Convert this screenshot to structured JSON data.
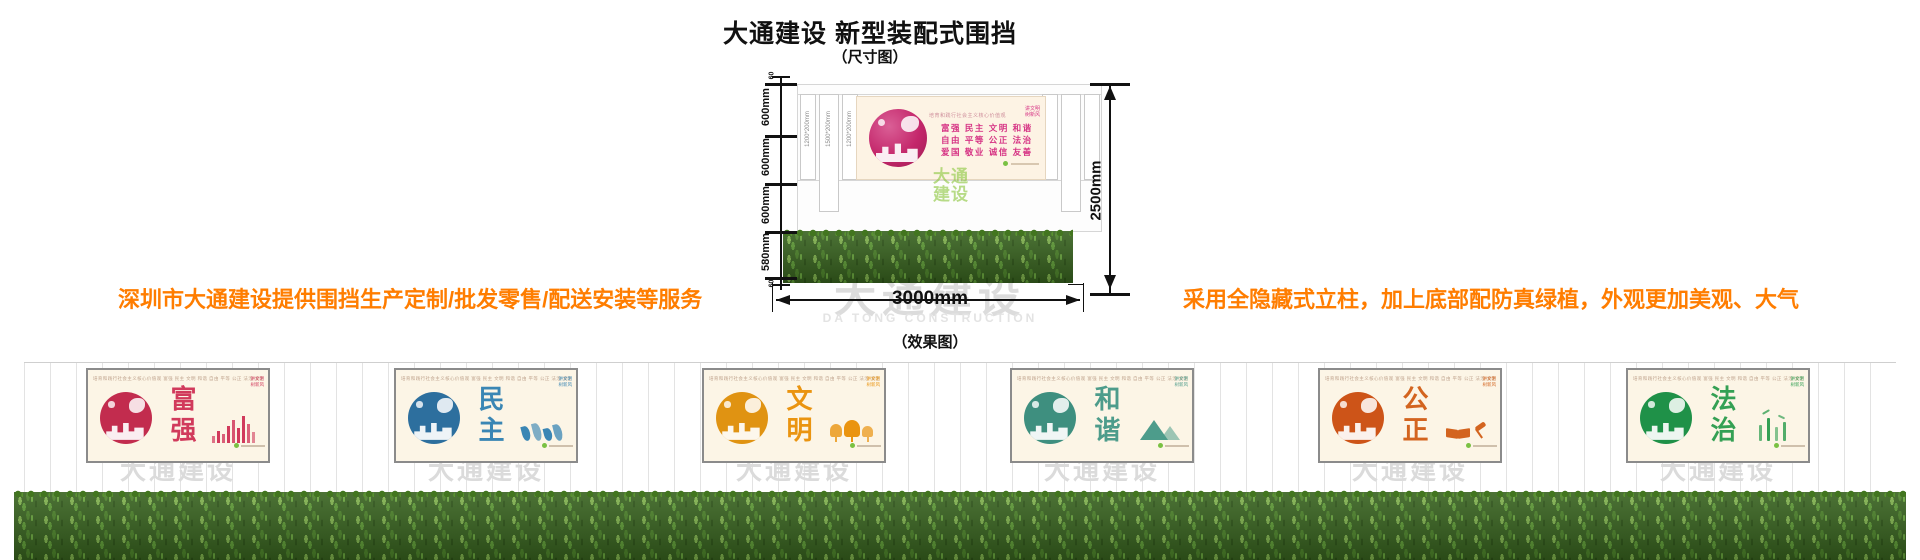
{
  "page": {
    "title": "大通建设 新型装配式围挡",
    "dim_caption": "（尺寸图）",
    "effect_caption": "（效果图）",
    "left_note": "深圳市大通建设提供围挡生产定制/批发零售/配送安装等服务",
    "right_note": "采用全隐藏式立柱，加上底部配防真绿植，外观更加美观、大气"
  },
  "colors": {
    "accent_orange": "#ff7d00",
    "values_pink": "#d63384",
    "green_watermark": "rgba(140,198,63,0.62)",
    "grass_green": "#38631f",
    "watermark_gray": "#dcdcdc"
  },
  "watermark": {
    "cn": "大通建设",
    "en": "DA TONG CONSTRUCTION"
  },
  "dimension_figure": {
    "axis": {
      "segments": [
        "600mm",
        "600mm",
        "600mm",
        "580mm"
      ],
      "cap_top": "60",
      "cap_bottom": "60"
    },
    "posts": [
      "1200*200mm",
      "1500*200mm",
      "1200*200mm"
    ],
    "total_height_label": "2500mm",
    "total_width_label": "3000mm",
    "billboard": {
      "heading": "培育和践行社会主义核心价值观",
      "value_lines": [
        "富强 民主 文明 和谐",
        "自由 平等 公正 法治",
        "爱国 敬业 诚信 友善"
      ],
      "corner_lines": [
        "讲文明",
        "树新风"
      ],
      "green_watermark_lines": [
        "大通",
        "建设"
      ]
    }
  },
  "effect": {
    "panel_top_line": "培育和践行社会主义核心价值观  富强 民主 文明 和谐 自由 平等 公正 法治 爱国 敬业 诚信 友善",
    "corner_lines": [
      "讲文明",
      "树新风"
    ],
    "panels": [
      {
        "word": "富强",
        "color": "#d13a5c",
        "circle": "#c22c4e",
        "icon": "city-bars"
      },
      {
        "word": "民主",
        "color": "#3a86b4",
        "circle": "#2d6f9e",
        "icon": "people-flags"
      },
      {
        "word": "文明",
        "color": "#ea9410",
        "circle": "#e09312",
        "icon": "trees"
      },
      {
        "word": "和谐",
        "color": "#4d9c8b",
        "circle": "#3e8f7f",
        "icon": "mountain"
      },
      {
        "word": "公正",
        "color": "#d3641f",
        "circle": "#cd5418",
        "icon": "book-gavel"
      },
      {
        "word": "法治",
        "color": "#34a054",
        "circle": "#1f9148",
        "icon": "bamboo"
      }
    ]
  }
}
